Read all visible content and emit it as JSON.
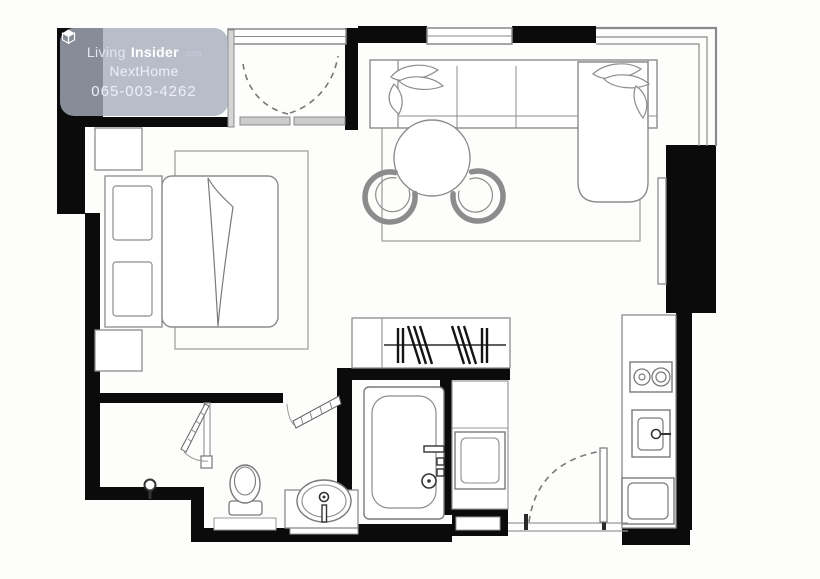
{
  "watermark": {
    "logo_icon": "cube",
    "brand_light": "Living",
    "brand_bold": "Insider",
    "brand_suffix": ".com",
    "agent_name": "NextHome",
    "phone": "065-003-4262"
  },
  "plan": {
    "background": "#ffffff",
    "wall_color": "#0b0b0b",
    "line_color": "#8c8c8c",
    "dark_line_color": "#333333",
    "door_leaf_color": "#cccccc",
    "badge_color": "rgba(167,173,189,0.8)",
    "symbols": [
      "bed",
      "pillows",
      "nightstands",
      "bedroom-rug",
      "wardrobe-hangers",
      "balcony-double-doors",
      "sofa",
      "chaise",
      "leaf-cushions",
      "dining-table",
      "chairs",
      "living-rug",
      "tv-panel",
      "kitchen-counter",
      "stove-2-burner",
      "kitchen-sink",
      "refrigerator",
      "bathtub",
      "toilet",
      "washbasin",
      "vanity",
      "shelf-unit",
      "entry-door",
      "bathroom-door",
      "storage-door",
      "floor-drain"
    ]
  }
}
